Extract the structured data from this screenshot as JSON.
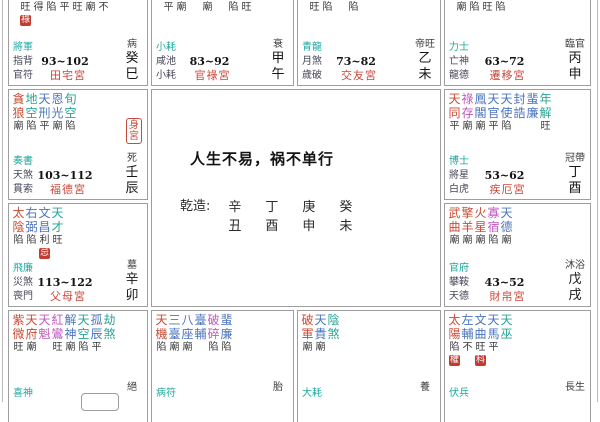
{
  "center": {
    "title": "人生不易，祸不单行",
    "pillars_label": "乾造:",
    "pillars": [
      {
        "stem": "辛",
        "branch": "丑"
      },
      {
        "stem": "丁",
        "branch": "酉"
      },
      {
        "stem": "庚",
        "branch": "申"
      },
      {
        "stem": "癸",
        "branch": "未"
      }
    ]
  },
  "colors": {
    "palace": "#c9483a",
    "god": "#1ba99c",
    "label": "#47475a",
    "badge_bg": "#c43a2e",
    "badge_text": "#ffffff",
    "star_red": "#cc4a33",
    "star_blue": "#4a74bd",
    "star_teal": "#2aa396",
    "star_magenta": "#bf59bd"
  },
  "palaces": [
    {
      "id": "si",
      "name": "田宅宮",
      "stem": "癸",
      "branch": "巳",
      "stage": "病",
      "age": "93~102",
      "gods": [
        "將軍",
        "指背",
        "官符"
      ],
      "bright_row": [
        "旺",
        "得",
        "陷",
        "平",
        "旺",
        "廟",
        "不"
      ],
      "bright_badge": {
        "col": 0,
        "char": "祿"
      }
    },
    {
      "id": "wu",
      "name": "官祿宮",
      "stem": "甲",
      "branch": "午",
      "stage": "衰",
      "age": "83~92",
      "gods": [
        "小耗",
        "咸池",
        "小耗"
      ],
      "bright_row": [
        "平",
        "廟",
        "",
        "廟",
        "",
        "陷",
        "旺"
      ]
    },
    {
      "id": "wei",
      "name": "交友宮",
      "stem": "乙",
      "branch": "未",
      "stage": "帝旺",
      "age": "73~82",
      "gods": [
        "青龍",
        "月煞",
        "歲破"
      ],
      "bright_row": [
        "旺",
        "陷",
        "",
        "陷"
      ]
    },
    {
      "id": "shen",
      "name": "遷移宮",
      "stem": "丙",
      "branch": "申",
      "stage": "臨官",
      "age": "63~72",
      "gods": [
        "力士",
        "亡神",
        "龍德"
      ],
      "bright_row": [
        "廟",
        "陷",
        "旺",
        "陷"
      ]
    },
    {
      "id": "chen",
      "name": "福德宮",
      "stem": "壬",
      "branch": "辰",
      "stage": "死",
      "age": "103~112",
      "gods": [
        "奏書",
        "天煞",
        "貫索"
      ],
      "body_palace": "身宮",
      "stars": [
        {
          "n": "貪狼",
          "b": "廟",
          "c": "red"
        },
        {
          "n": "地空",
          "b": "陷",
          "c": "teal"
        },
        {
          "n": "天刑",
          "b": "平",
          "c": "blue"
        },
        {
          "n": "恩光",
          "b": "廟",
          "c": "blue"
        },
        {
          "n": "旬空",
          "b": "陷",
          "c": "teal"
        }
      ]
    },
    {
      "id": "you",
      "name": "疾厄宮",
      "stem": "丁",
      "branch": "酉",
      "stage": "冠帶",
      "age": "53~62",
      "gods": [
        "博士",
        "將星",
        "白虎"
      ],
      "stars": [
        {
          "n": "天同",
          "b": "平",
          "c": "red"
        },
        {
          "n": "祿存",
          "b": "廟",
          "c": "magenta"
        },
        {
          "n": "鳳閣",
          "b": "廟",
          "c": "blue"
        },
        {
          "n": "天官",
          "b": "平",
          "c": "blue"
        },
        {
          "n": "天使",
          "b": "陷",
          "c": "blue"
        },
        {
          "n": "封誥",
          "b": "",
          "c": "blue"
        },
        {
          "n": "蜚廉",
          "b": "",
          "c": "blue"
        },
        {
          "n": "年解",
          "b": "旺",
          "c": "teal"
        }
      ]
    },
    {
      "id": "mao",
      "name": "父母宮",
      "stem": "辛",
      "branch": "卯",
      "stage": "墓",
      "age": "113~122",
      "gods": [
        "飛廉",
        "災煞",
        "喪門"
      ],
      "stars": [
        {
          "n": "太陰",
          "b": "陷",
          "c": "red"
        },
        {
          "n": "右弼",
          "b": "陷",
          "c": "blue"
        },
        {
          "n": "文昌",
          "b": "利",
          "c": "blue",
          "t": "忌"
        },
        {
          "n": "天才",
          "b": "旺",
          "c": "teal"
        }
      ]
    },
    {
      "id": "xu",
      "name": "財帛宮",
      "stem": "戊",
      "branch": "戌",
      "stage": "沐浴",
      "age": "43~52",
      "gods": [
        "官府",
        "攀鞍",
        "天德"
      ],
      "stars": [
        {
          "n": "武曲",
          "b": "廟",
          "c": "red"
        },
        {
          "n": "擎羊",
          "b": "廟",
          "c": "red"
        },
        {
          "n": "火星",
          "b": "廟",
          "c": "red"
        },
        {
          "n": "寡宿",
          "b": "陷",
          "c": "magenta"
        },
        {
          "n": "天德",
          "b": "廟",
          "c": "blue"
        }
      ]
    },
    {
      "id": "yin",
      "name": "",
      "stem": "",
      "branch": "",
      "stage": "絕",
      "age": "",
      "gods": [
        "喜神"
      ],
      "cut": true,
      "cutbox": true,
      "stars": [
        {
          "n": "紫微",
          "b": "旺",
          "c": "red"
        },
        {
          "n": "天府",
          "b": "廟",
          "c": "red"
        },
        {
          "n": "天魁",
          "b": "",
          "c": "magenta"
        },
        {
          "n": "紅鸞",
          "b": "旺",
          "c": "magenta"
        },
        {
          "n": "解神",
          "b": "廟",
          "c": "blue"
        },
        {
          "n": "天空",
          "b": "陷",
          "c": "teal"
        },
        {
          "n": "孤辰",
          "b": "平",
          "c": "blue"
        },
        {
          "n": "劫煞",
          "b": "",
          "c": "teal"
        }
      ]
    },
    {
      "id": "chou",
      "name": "",
      "stem": "",
      "branch": "",
      "stage": "胎",
      "age": "",
      "gods": [
        "病符"
      ],
      "cut": true,
      "stars": [
        {
          "n": "天機",
          "b": "陷",
          "c": "red"
        },
        {
          "n": "三臺",
          "b": "廟",
          "c": "blue"
        },
        {
          "n": "八座",
          "b": "廟",
          "c": "blue"
        },
        {
          "n": "臺輔",
          "b": "",
          "c": "blue"
        },
        {
          "n": "破碎",
          "b": "陷",
          "c": "magenta"
        },
        {
          "n": "蜚廉",
          "b": "陷",
          "c": "blue"
        }
      ]
    },
    {
      "id": "zi",
      "name": "",
      "stem": "",
      "branch": "",
      "stage": "養",
      "age": "",
      "gods": [
        "大耗"
      ],
      "cut": true,
      "stars": [
        {
          "n": "破軍",
          "b": "廟",
          "c": "red"
        },
        {
          "n": "天貴",
          "b": "廟",
          "c": "blue"
        },
        {
          "n": "陰煞",
          "b": "",
          "c": "teal"
        }
      ]
    },
    {
      "id": "hai",
      "name": "",
      "stem": "",
      "branch": "",
      "stage": "長生",
      "age": "",
      "gods": [
        "伏兵"
      ],
      "cut": true,
      "stars": [
        {
          "n": "太陽",
          "b": "陷",
          "c": "red",
          "t": "權"
        },
        {
          "n": "左輔",
          "b": "不",
          "c": "blue"
        },
        {
          "n": "文曲",
          "b": "旺",
          "c": "blue",
          "t": "科"
        },
        {
          "n": "天馬",
          "b": "平",
          "c": "blue"
        },
        {
          "n": "天巫",
          "b": "",
          "c": "teal"
        }
      ]
    }
  ]
}
